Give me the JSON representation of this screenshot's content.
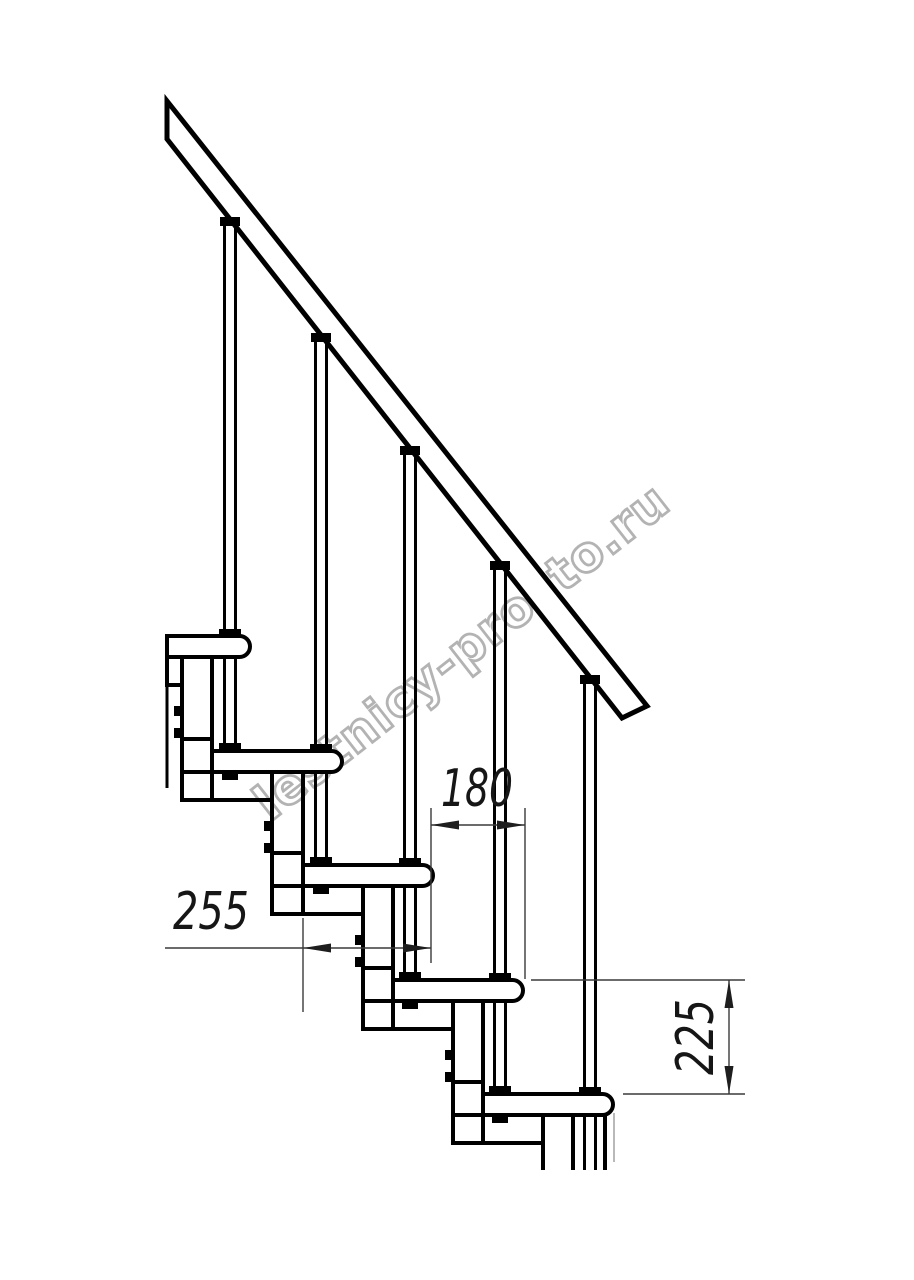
{
  "watermark": {
    "text": "lestnicy-prosto.ru",
    "color": "#b3b3b3"
  },
  "dimensions": {
    "step_overlap_mm": "180",
    "step_depth_mm": "255",
    "step_rise_mm": "225"
  },
  "style": {
    "line_color": "#000000",
    "dimension_line_color": "#3a3a3a",
    "background_color": "#ffffff"
  }
}
